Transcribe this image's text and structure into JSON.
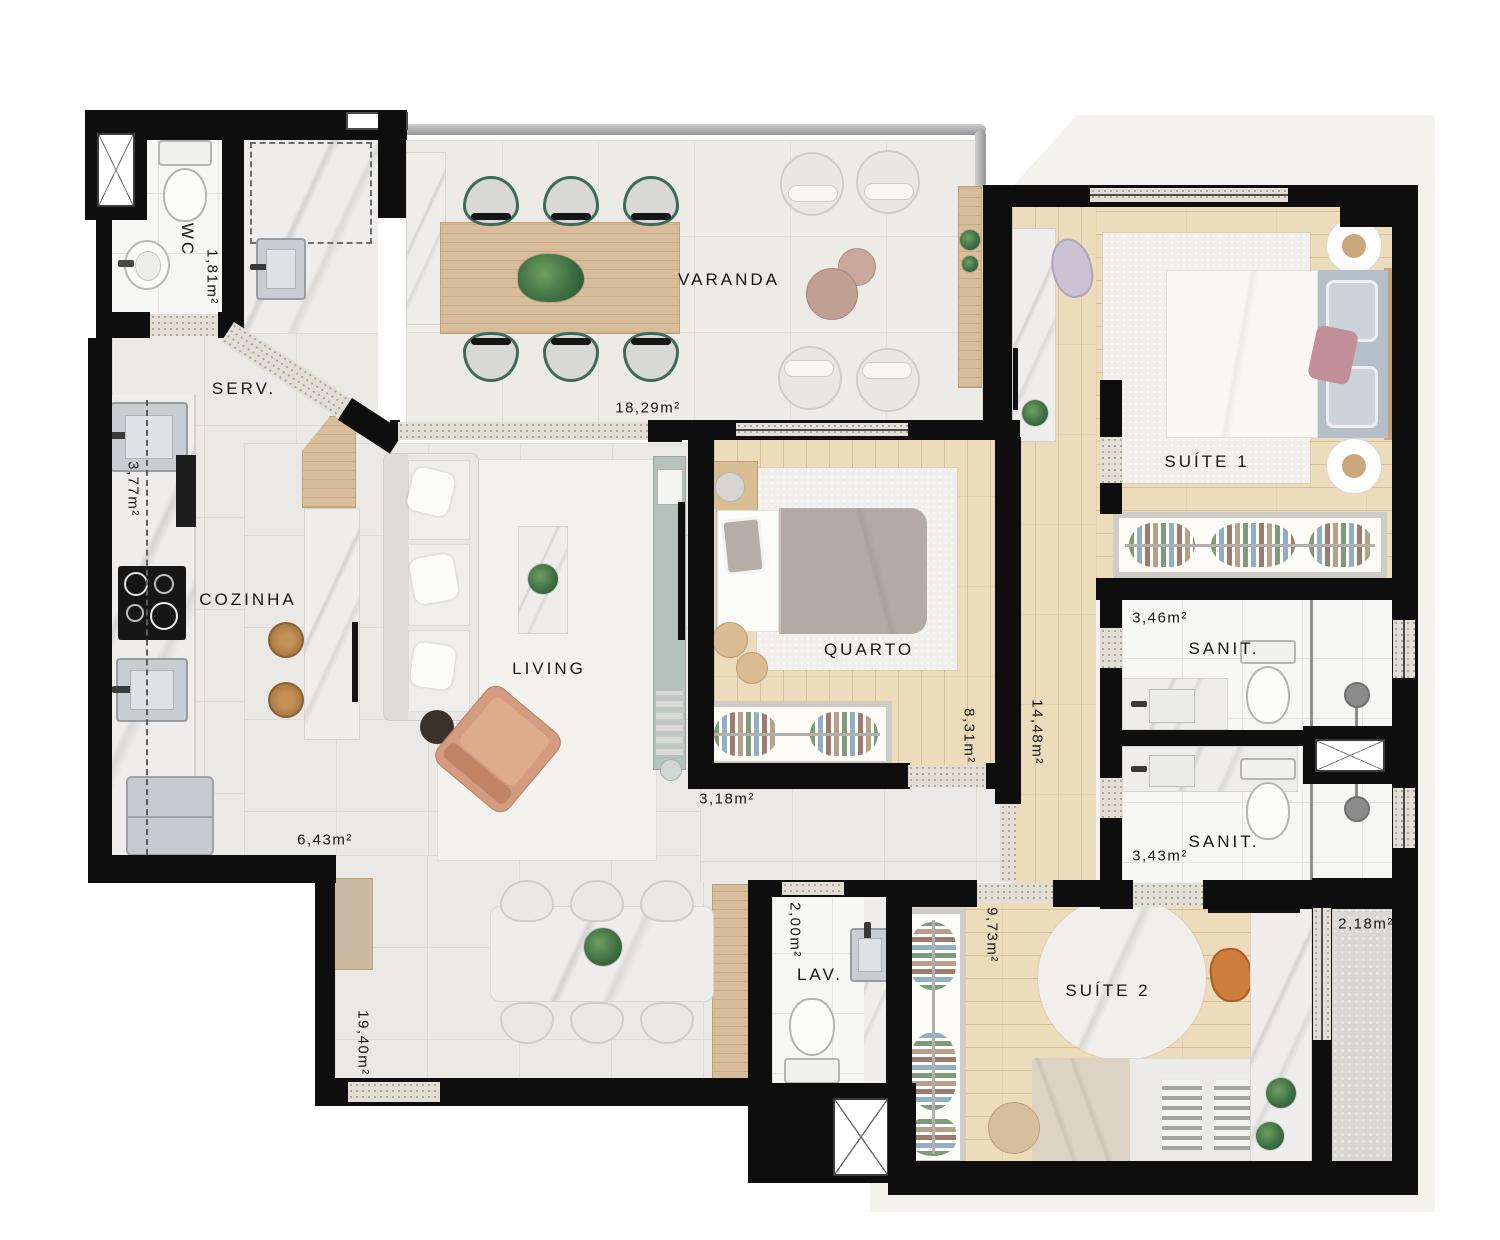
{
  "floorplan": {
    "rooms": {
      "wc": {
        "label": "WC",
        "area": "1,81m²"
      },
      "servico": {
        "label": "SERV."
      },
      "varanda": {
        "label": "VARANDA",
        "area": "18,29m²"
      },
      "cozinha": {
        "label": "COZINHA",
        "area_bancada": "3,77m²",
        "area_circulacao": "6,43m²"
      },
      "living": {
        "label": "LIVING",
        "area_jantar": "19,40m²",
        "area_hall": "3,18m²"
      },
      "quarto": {
        "label": "QUARTO",
        "area": "8,31m²"
      },
      "hall_intimo": {
        "area": "14,48m²"
      },
      "suite1": {
        "label": "SUÍTE 1"
      },
      "sanit1": {
        "label": "SANIT.",
        "area": "3,46m²"
      },
      "sanit2": {
        "label": "SANIT.",
        "area": "3,43m²"
      },
      "lav": {
        "label": "LAV.",
        "area": "2,00m²"
      },
      "suite2": {
        "label": "SUÍTE 2",
        "area": "9,73m²"
      },
      "terraco": {
        "area": "2,18m²"
      }
    },
    "colors": {
      "wall": "#0e0e0e",
      "tile_floor": "#ebe9e5",
      "wood_floor": "#ecdcbc",
      "bath_floor": "#f6f6f4",
      "marble": "#eeedeb",
      "threshold_granite": "#e2ded6",
      "chair_green": "#3c6b5c",
      "armchair_terracotta": "#d09579",
      "tv_rack_sage": "#b5c1bd"
    }
  }
}
